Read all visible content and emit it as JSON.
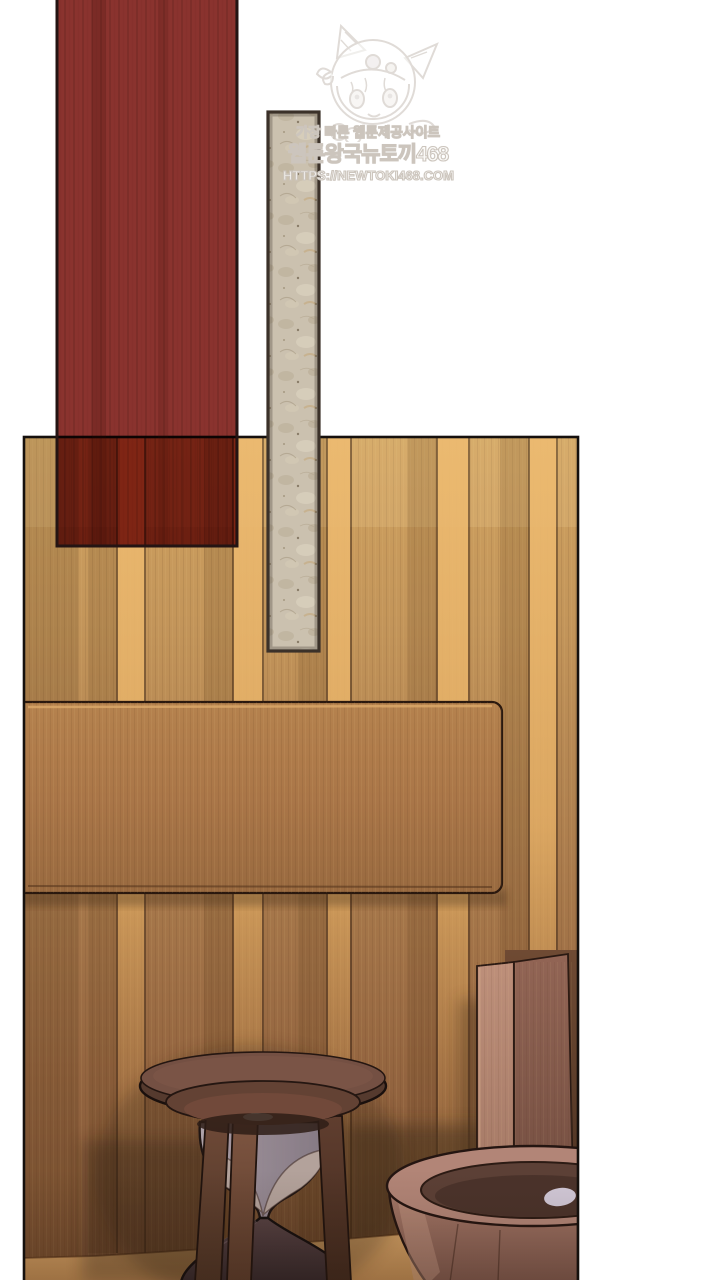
{
  "page": {
    "kind": "webtoon-episode-page",
    "background": "#ffffff"
  },
  "watermark": {
    "mascot_icon": "rabbit-hood-chibi-mascot-icon",
    "tagline": "가장 빠른 웹툰제공사이트",
    "site_name": "웹툰왕국뉴토끼468",
    "site_url": "HTTPS://NEWTOKI468.COM"
  },
  "artwork": {
    "red_banner_label": "dark red hanging drape",
    "scroll_label": "beige paper scroll strip",
    "panel_label": "wood panelled room with hourglass, pillar and basin",
    "objects": [
      "wall-board",
      "hourglass-stand",
      "wooden-pillar",
      "wooden-basin",
      "floor"
    ]
  },
  "colors": {
    "page_bg": "#ffffff",
    "wm_text": "#fbfaf8",
    "wm_stroke": "#ccc5bd",
    "red_banner": "#8a332e",
    "red_border": "#241413",
    "scroll_fill": "#cbc1af",
    "scroll_border": "#3b3129",
    "panel_border": "#15100d",
    "wood_light": "#cfa260",
    "wood_mid": "#b08150",
    "wood_dark": "#7d5334",
    "gap_highlight": "#ecba70",
    "board_fill": "#ab764a",
    "floor_fill": "#cf9d61",
    "pillar_front": "#b98c77",
    "pillar_side": "#8f6354",
    "basin_wood": "#a87a6a",
    "basin_interior": "#5c4036",
    "hourglass_cap": "#745043",
    "glass_tint": "#a195a0",
    "sand_top": "#b3a29b",
    "sand_base": "#42312f"
  }
}
